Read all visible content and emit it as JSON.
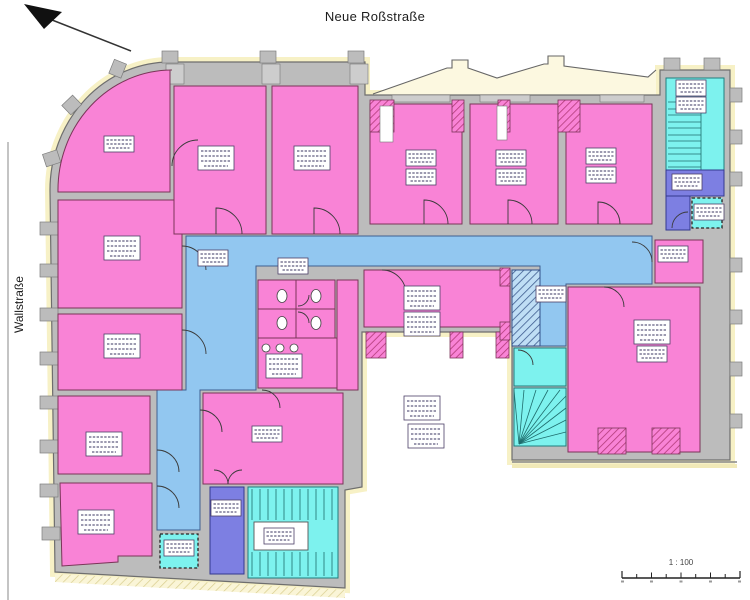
{
  "labels": {
    "street_top": "Neue Roßstraße",
    "street_left": "Wallstraße",
    "scale": "1 : 100"
  },
  "icons": {
    "north_arrow": "north-arrow-icon",
    "scale_bar": "scale-bar"
  },
  "colors": {
    "room_pink": "#f983d6",
    "room_border": "#7a3558",
    "corridor_blue": "#92c7f0",
    "corridor_border": "#3f5f91",
    "stair_cyan": "#7df2ee",
    "stair_border": "#1f7d7d",
    "elevator_purple": "#7d7fe2",
    "elevator_border": "#34398f",
    "wall_gray": "#bcbcbc",
    "wall_edge": "#6e6e6e",
    "facade_yellow": "#f7f1c6",
    "hatch_pink_line": "#b23a78",
    "hatch_blue_bg": "#bfdef5",
    "hatch_blue_line": "#3d5c8f",
    "chip_bg": "#ffffff",
    "chip_line": "#3a3560",
    "ink": "#1c1c1c"
  },
  "plan": {
    "areas": {
      "pink_rooms": 16,
      "corridor_segments": 1,
      "stairwells": 3,
      "elevators": 2,
      "dashed_shaft_boxes": 2,
      "wc_cells": 4,
      "courtyard": 1
    }
  }
}
